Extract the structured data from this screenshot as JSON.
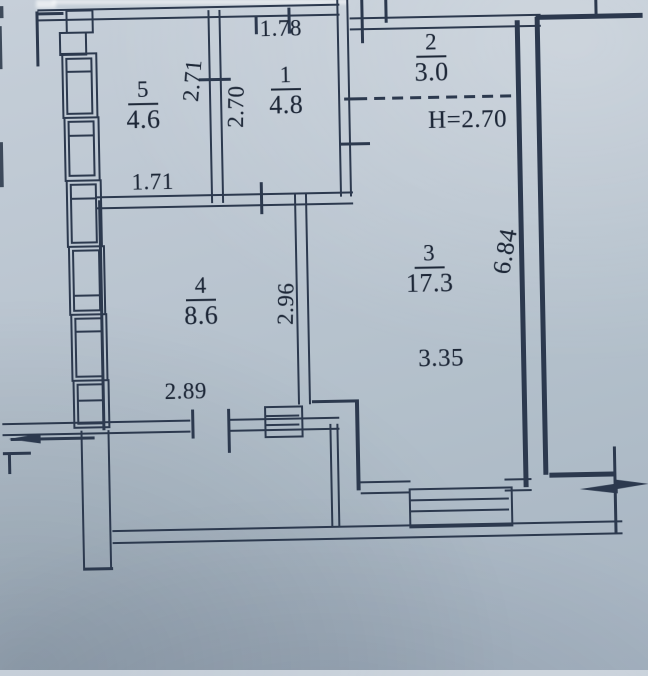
{
  "rooms": [
    {
      "number": "5",
      "area": "4.6"
    },
    {
      "number": "1",
      "area": "4.8"
    },
    {
      "number": "2",
      "area": "3.0"
    },
    {
      "number": "3",
      "area": "17.3"
    },
    {
      "number": "4",
      "area": "8.6"
    }
  ],
  "dimensions": {
    "room5_width": "1.71",
    "room5_height": "2.71",
    "room1_width": "1.78",
    "room1_height": "2.70",
    "room4_width": "2.89",
    "room4_height": "2.96",
    "room3_width": "3.35",
    "room3_side": "6.84"
  },
  "annotations": {
    "ceiling_height": "H=2.70"
  }
}
